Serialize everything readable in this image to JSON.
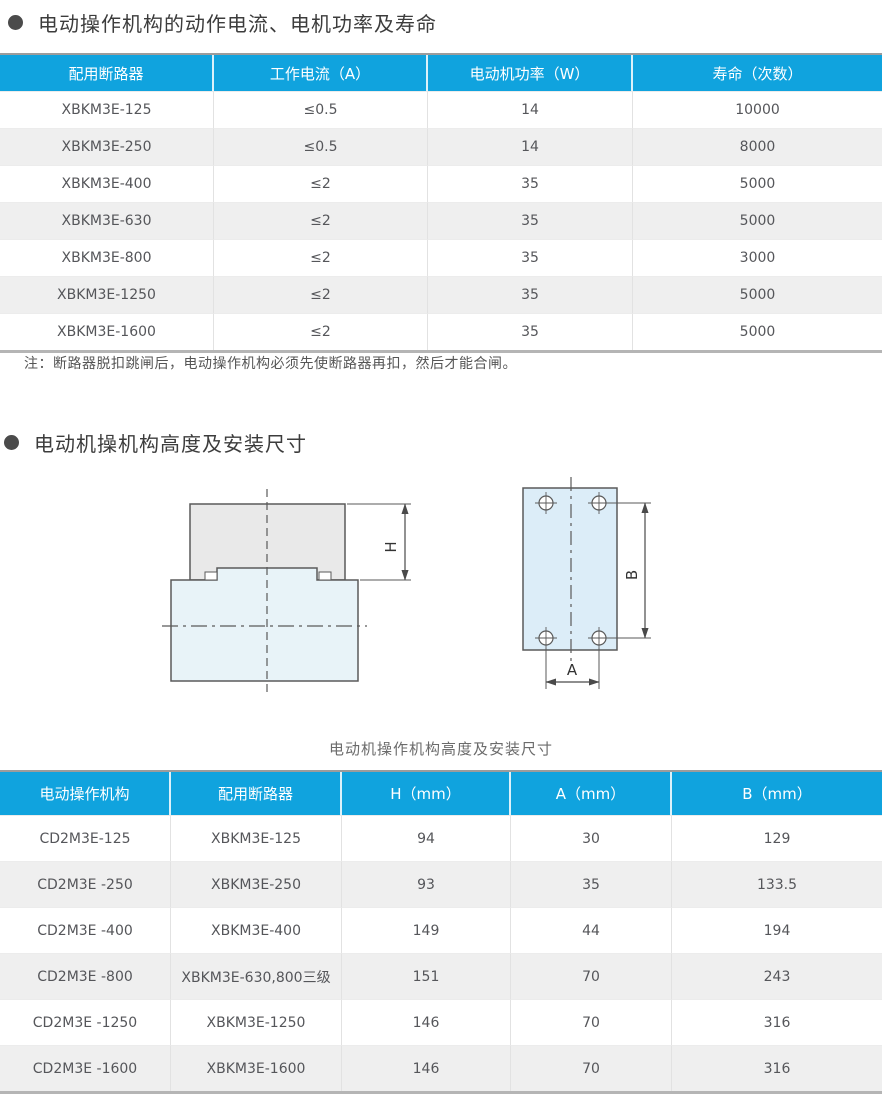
{
  "section1": {
    "heading": "电动操作机构的动作电流、电机功率及寿命",
    "table": {
      "headers": [
        "配用断路器",
        "工作电流（A）",
        "电动机功率（W）",
        "寿命（次数）"
      ],
      "rows": [
        [
          "XBKM3E-125",
          "≤0.5",
          "14",
          "10000"
        ],
        [
          "XBKM3E-250",
          "≤0.5",
          "14",
          "8000"
        ],
        [
          "XBKM3E-400",
          "≤2",
          "35",
          "5000"
        ],
        [
          "XBKM3E-630",
          "≤2",
          "35",
          "5000"
        ],
        [
          "XBKM3E-800",
          "≤2",
          "35",
          "3000"
        ],
        [
          "XBKM3E-1250",
          "≤2",
          "35",
          "5000"
        ],
        [
          "XBKM3E-1600",
          "≤2",
          "35",
          "5000"
        ]
      ]
    },
    "note": "注：断路器脱扣跳闸后，电动操作机构必须先使断路器再扣，然后才能合闸。"
  },
  "section2": {
    "heading": "电动机操机构高度及安装尺寸",
    "diagram": {
      "labels": {
        "h": "H",
        "a": "A",
        "b": "B"
      },
      "caption": "电动机操作机构高度及安装尺寸"
    },
    "table": {
      "headers": [
        "电动操作机构",
        "配用断路器",
        "H（mm）",
        "A（mm）",
        "B（mm）"
      ],
      "rows": [
        [
          "CD2M3E-125",
          "XBKM3E-125",
          "94",
          "30",
          "129"
        ],
        [
          "CD2M3E -250",
          "XBKM3E-250",
          "93",
          "35",
          "133.5"
        ],
        [
          "CD2M3E -400",
          "XBKM3E-400",
          "149",
          "44",
          "194"
        ],
        [
          "CD2M3E -800",
          "XBKM3E-630,800三级",
          "151",
          "70",
          "243"
        ],
        [
          "CD2M3E -1250",
          "XBKM3E-1250",
          "146",
          "70",
          "316"
        ],
        [
          "CD2M3E -1600",
          "XBKM3E-1600",
          "146",
          "70",
          "316"
        ]
      ]
    }
  },
  "colors": {
    "accent_blue": "#10a3de",
    "stripe_gray": "#efefef",
    "heading_text": "#3c3c3c",
    "body_text": "#58585a"
  },
  "icons": [
    "bullet-icon"
  ]
}
